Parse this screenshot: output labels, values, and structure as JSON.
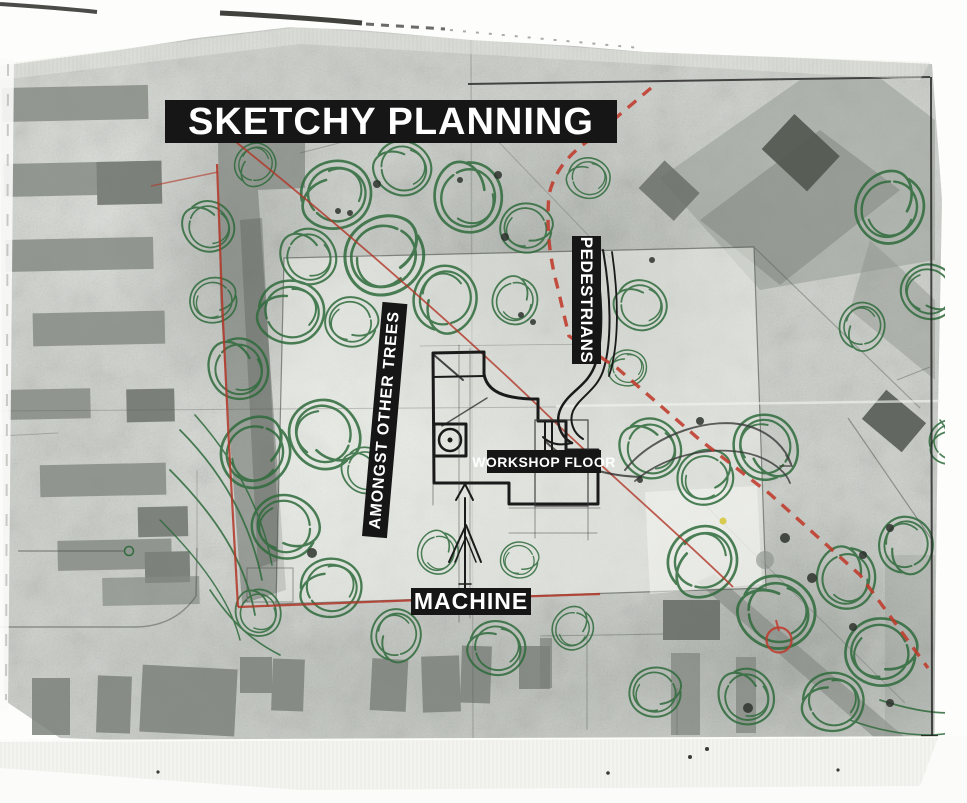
{
  "map": {
    "title": "SKETCHY PLANNING",
    "labels": {
      "pedestrians": "PEDESTRIANS",
      "amongst_other_trees": "AMONGST OTHER TREES",
      "workshop_floor": "WORKSHOP FLOOR",
      "machine": "MACHINE"
    },
    "colors": {
      "banner_background": "#161616",
      "banner_text": "#ffffff",
      "tree_scribble_green": "#2f6b3c",
      "site_boundary_red": "#b23527",
      "route_dashed_red": "#bf3a2b",
      "ink_sketch_black": "#1a1a1a",
      "paper_gray": "#cacec8"
    }
  }
}
